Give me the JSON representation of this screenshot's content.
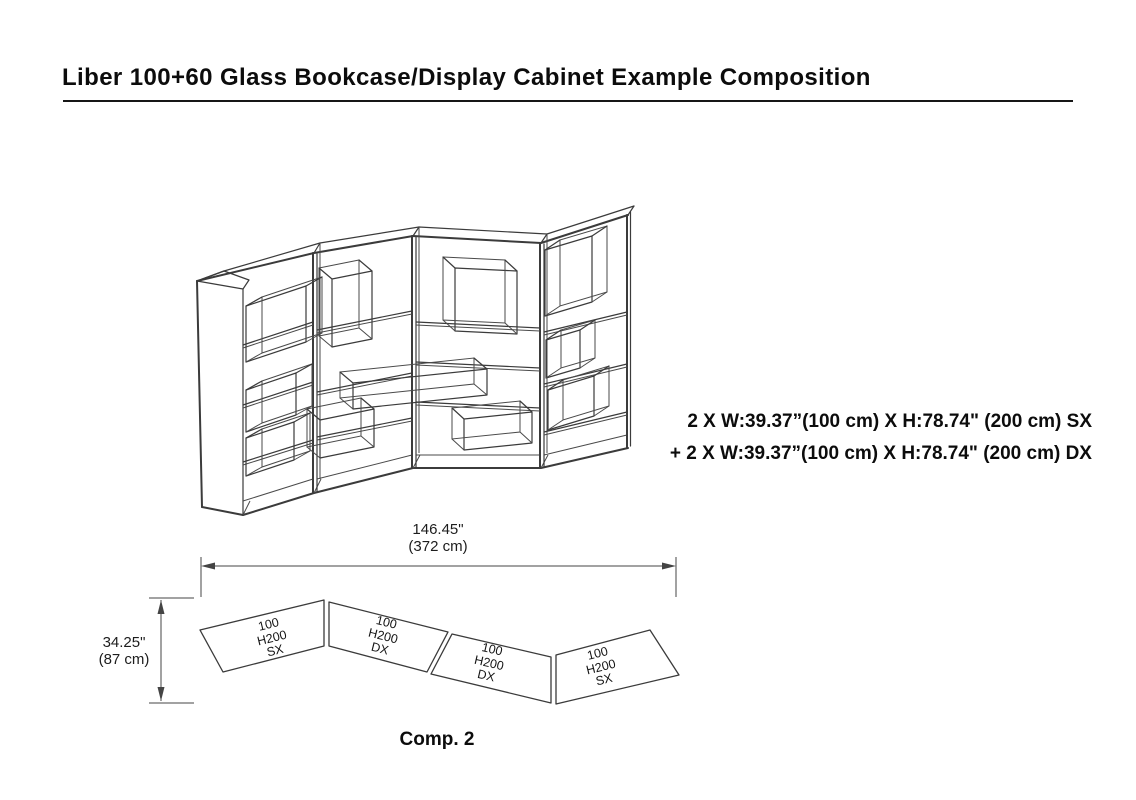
{
  "document": {
    "title": "Liber 100+60 Glass Bookcase/Display Cabinet Example Composition",
    "caption": "Comp. 2"
  },
  "spec": {
    "line1": "2 X W:39.37”(100 cm) X H:78.74\" (200 cm) SX",
    "line2": "+ 2 X W:39.37”(100 cm) X H:78.74\" (200 cm) DX"
  },
  "dimensions": {
    "overall_width_in": "146.45\"",
    "overall_width_cm": "(372 cm)",
    "overall_depth_in": "34.25\"",
    "overall_depth_cm": "(87 cm)"
  },
  "plan_panels": [
    {
      "size": "100",
      "height": "H200",
      "side": "SX"
    },
    {
      "size": "100",
      "height": "H200",
      "side": "DX"
    },
    {
      "size": "100",
      "height": "H200",
      "side": "DX"
    },
    {
      "size": "100",
      "height": "H200",
      "side": "SX"
    }
  ]
}
